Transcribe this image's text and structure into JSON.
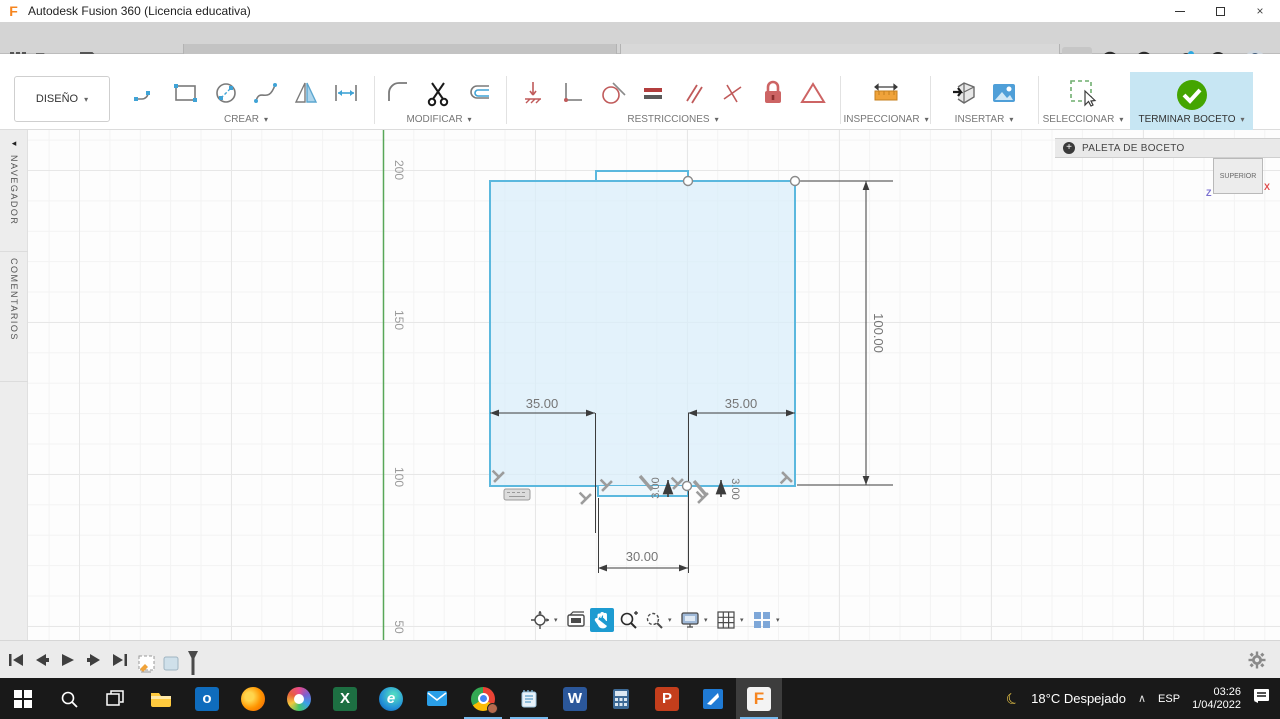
{
  "titlebar": {
    "app_title": "Autodesk Fusion 360 (Licencia educativa)",
    "logo_glyph": "F",
    "close_glyph": "×"
  },
  "tabs": {
    "items": [
      {
        "label": "Ensamble v3*"
      },
      {
        "label": "Cara Base v1*"
      }
    ],
    "close_glyph": "×",
    "add_glyph": "+",
    "job_badge": "1",
    "help_glyph": "?"
  },
  "ribbon": {
    "tabs": [
      {
        "label": "SOLIDO"
      },
      {
        "label": "SUPERFICIE"
      },
      {
        "label": "MALLA"
      },
      {
        "label": "CHAPA"
      },
      {
        "label": "PLÁSTICO"
      },
      {
        "label": "UTILIDADES"
      },
      {
        "label": "BOCETO"
      }
    ],
    "design_label": "DISEÑO",
    "caret": "▾",
    "groups": {
      "crear": "CREAR",
      "modificar": "MODIFICAR",
      "restricciones": "RESTRICCIONES",
      "inspeccionar": "INSPECCIONAR",
      "insertar": "INSERTAR",
      "seleccionar": "SELECCIONAR",
      "terminar": "TERMINAR BOCETO"
    }
  },
  "left_rail": {
    "navegador": "NAVEGADOR",
    "comentarios": "COMENTARIOS",
    "collapse_glyph": "◂"
  },
  "palette": {
    "title": "PALETA DE BOCETO",
    "expand_glyph": "+"
  },
  "viewcube": {
    "face": "SUPERIOR",
    "z": "Z",
    "x": "X"
  },
  "canvas": {
    "ruler": [
      "200",
      "150",
      "100",
      "50"
    ],
    "dims": {
      "left_width": "35.00",
      "right_width": "35.00",
      "height": "100.00",
      "slot_width": "30.00",
      "depth_left": "3.00",
      "depth_right": "3.00"
    }
  },
  "tray": {
    "moon": "☾",
    "temperature": "18°C",
    "condition": "Despejado",
    "chevron": "∧",
    "lang": "ESP",
    "time": "03:26",
    "date": "1/04/2022"
  },
  "taskbar_letters": {
    "outlook": "o",
    "excel": "X",
    "edge": "e",
    "word": "W",
    "powerpoint": "P",
    "fusion": "F"
  },
  "colors": {
    "accent_blue": "#0696d7",
    "sketch_blue": "#5bb8de",
    "constraint_red": "#c05a5a",
    "terminar_green": "#44a501"
  }
}
